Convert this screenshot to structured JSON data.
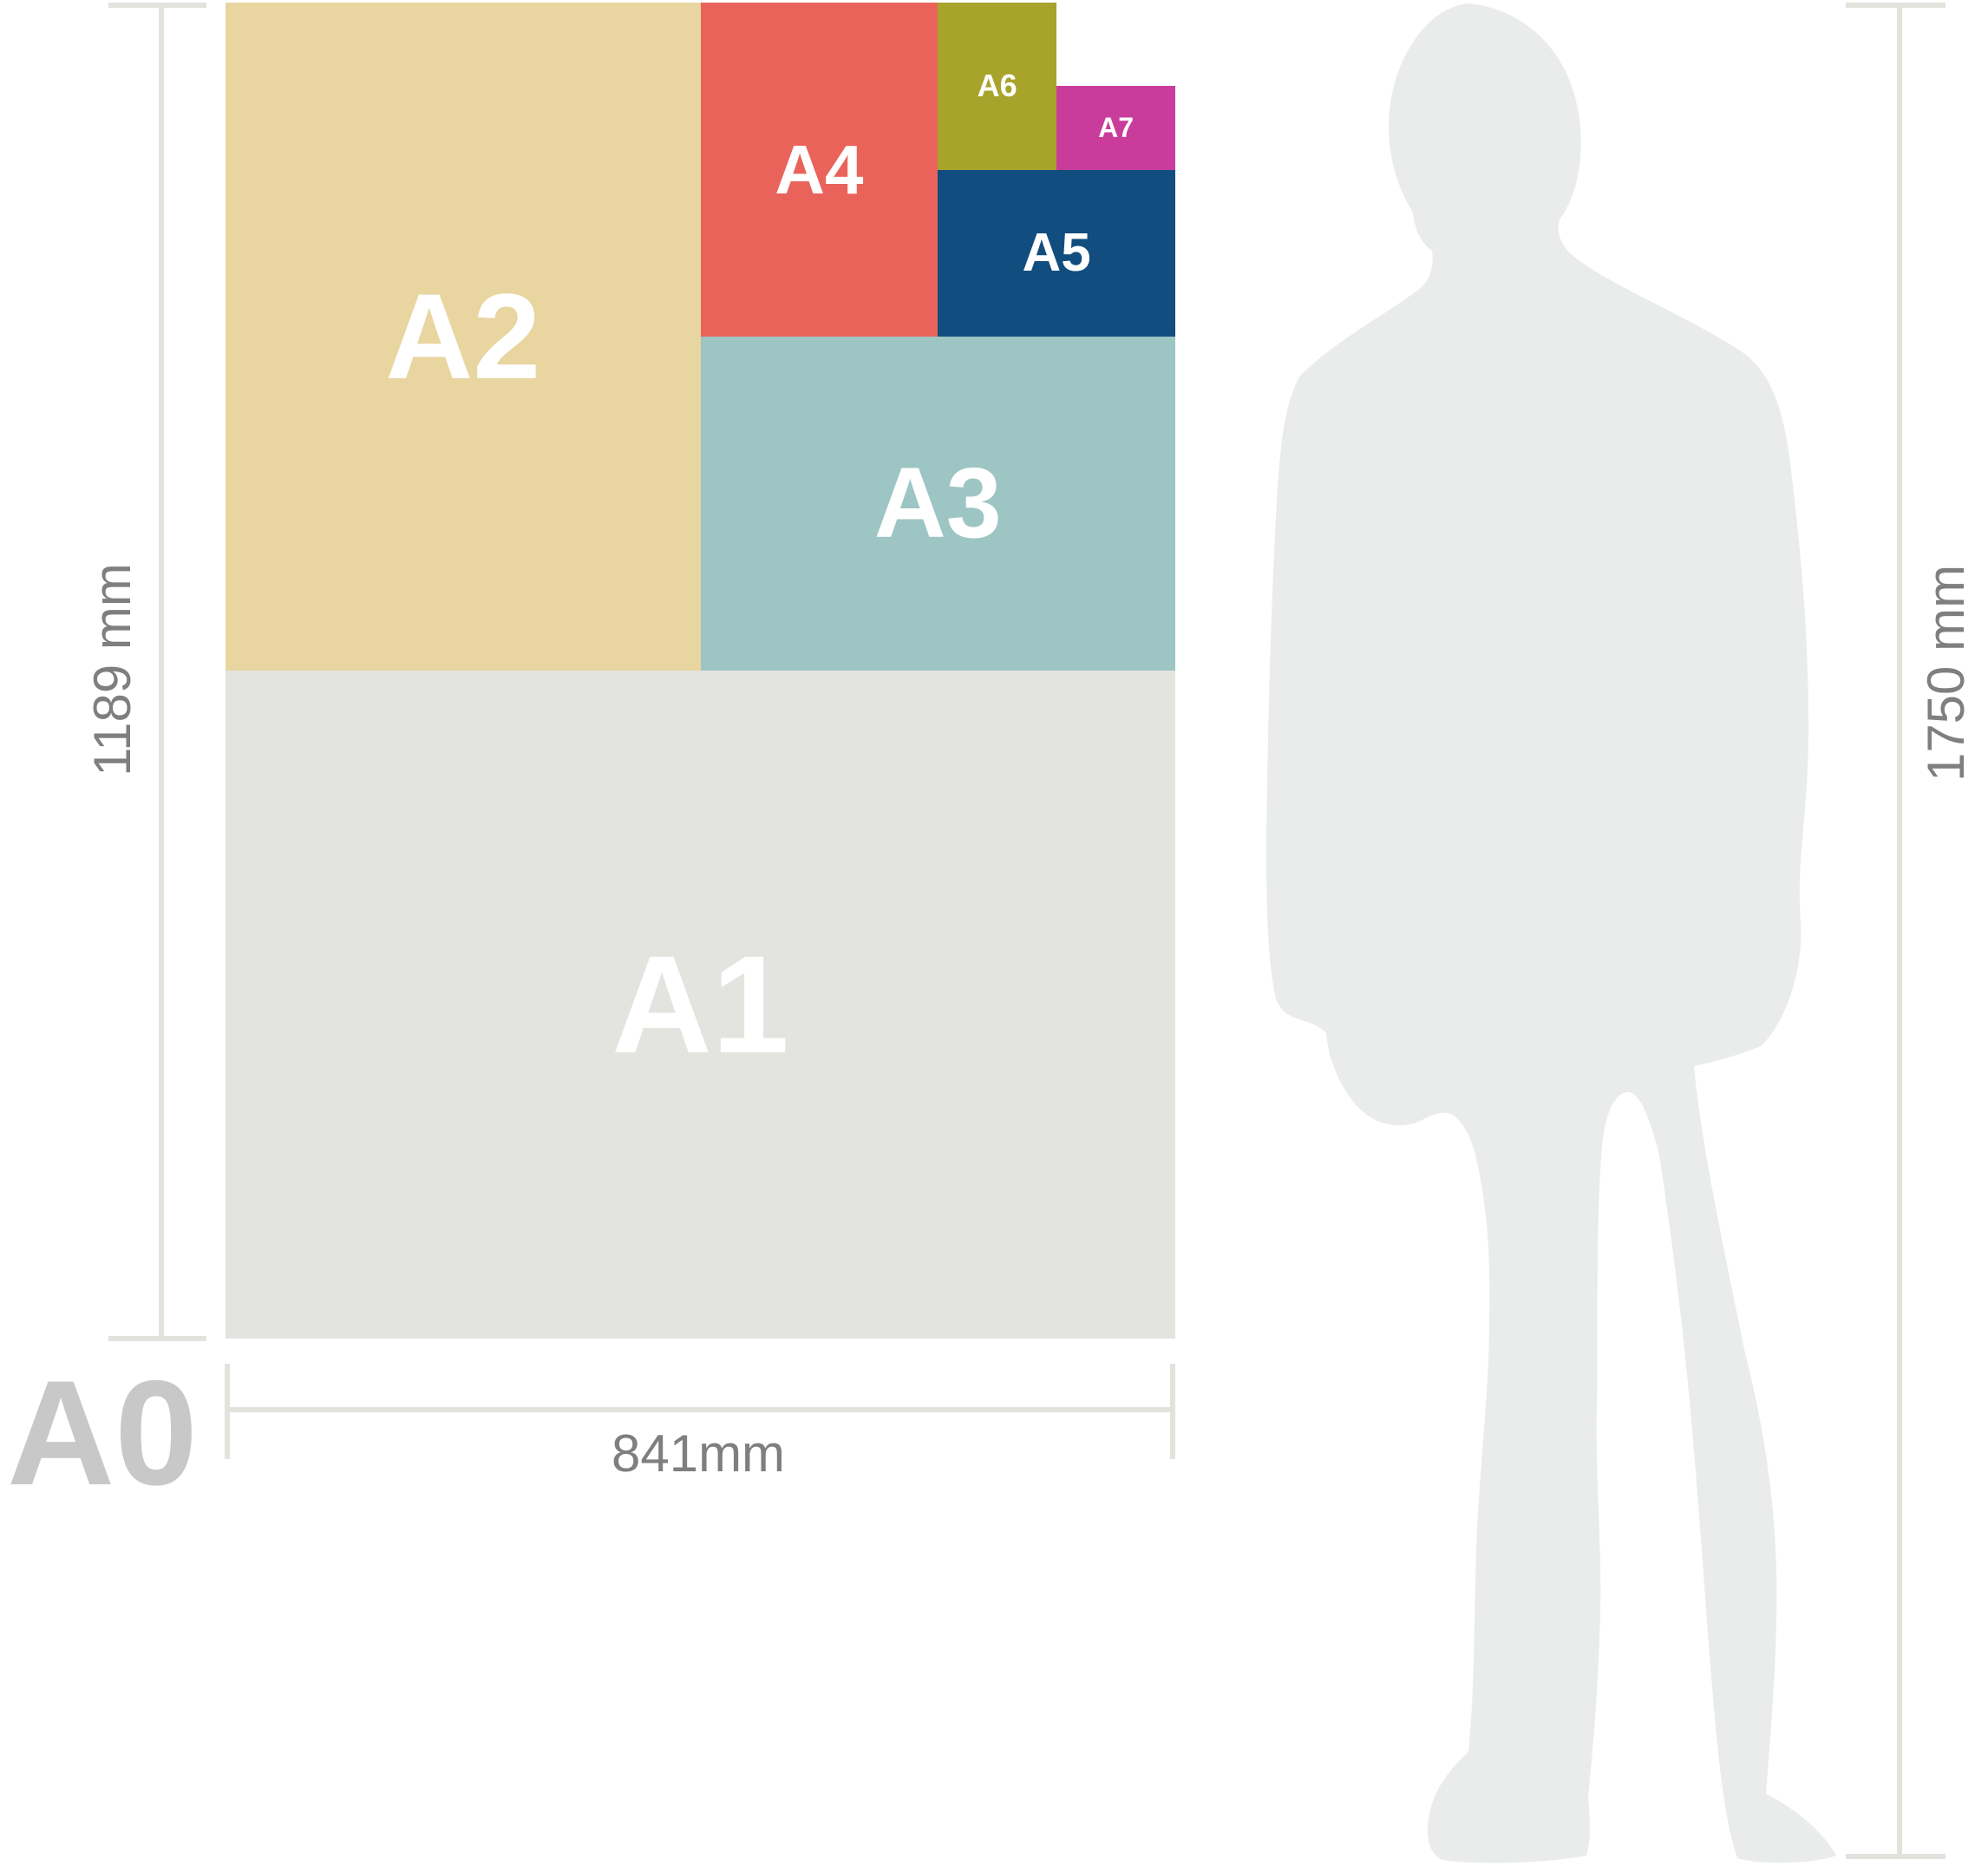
{
  "diagram": {
    "sheet_label": "A0",
    "papers": [
      {
        "label": "A1",
        "color": "#E3E4DF"
      },
      {
        "label": "A2",
        "color": "#E8D5A0"
      },
      {
        "label": "A3",
        "color": "#9DC5C3"
      },
      {
        "label": "A4",
        "color": "#E9635A"
      },
      {
        "label": "A5",
        "color": "#114D7E"
      },
      {
        "label": "A6",
        "color": "#A8A32B"
      },
      {
        "label": "A7",
        "color": "#C93C9B"
      }
    ],
    "dimensions": {
      "sheet_height_label": "1189 mm",
      "sheet_width_label": "841mm",
      "person_height_label": "1750 mm"
    },
    "colors": {
      "paper_label_text": "#FFFFFF",
      "dimension_text": "#7F7F7F",
      "dimension_line": "#E3E3DE",
      "sheet_label_text": "#C8C8C8",
      "silhouette": "#EAECEB"
    }
  }
}
